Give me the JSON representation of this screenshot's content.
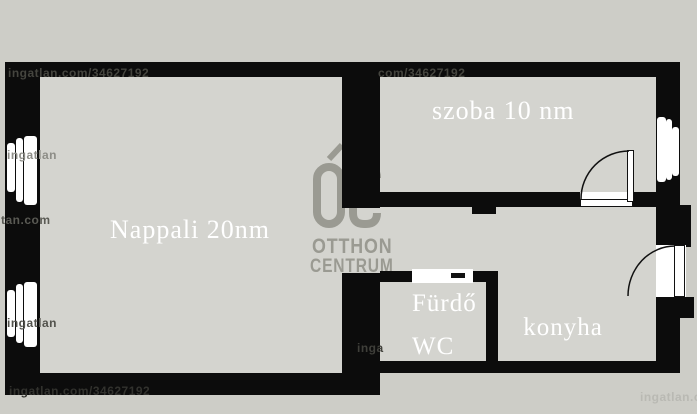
{
  "title": "apartment floor plan",
  "rooms": {
    "nappali": {
      "label": "Nappali 20nm"
    },
    "szoba": {
      "label": "szoba 10 nm"
    },
    "furdo": {
      "label_line1": "Fürdő",
      "label_line2": "WC"
    },
    "konyha": {
      "label": "konyha"
    }
  },
  "logo": {
    "monogram": "ÓC",
    "line1": "OTTHON",
    "line2": "CENTRUM"
  },
  "watermarks": [
    {
      "text": "ingatlan.com/34627192"
    },
    {
      "text": "com/34627192"
    },
    {
      "text": "tan.com"
    },
    {
      "text": "ingatlan"
    },
    {
      "text": "ingatlan"
    },
    {
      "text": "inga"
    },
    {
      "text": "ingatlan.com/34627192"
    },
    {
      "text": "ingatlan.com"
    }
  ],
  "colors": {
    "wall": "#0c0c0c",
    "floor": "#d4d4cf",
    "exterior": "#cdcdc7",
    "label": "#ffffff",
    "logo": "#9a9a92",
    "door": "#ffffff"
  }
}
